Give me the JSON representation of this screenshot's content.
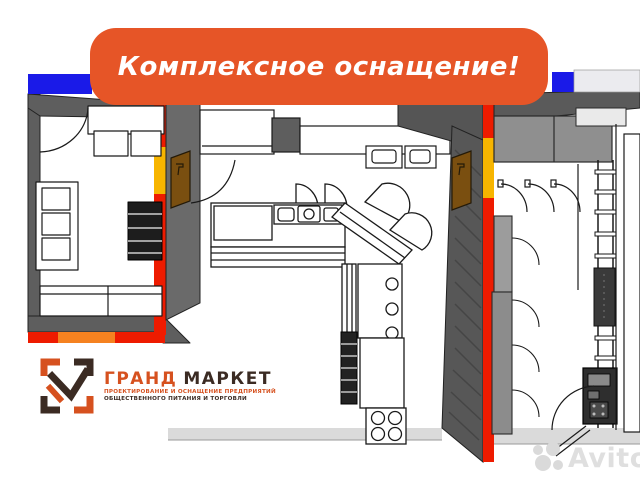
{
  "banner": {
    "text": "Комплексное оснащение!"
  },
  "logo": {
    "brand_first_word": "ГРАНД",
    "brand_second_word": "МАРКЕТ",
    "tagline_line1": "ПРОЕКТИРОВАНИЕ И ОСНАЩЕНИЕ ПРЕДПРИЯТИЙ",
    "tagline_line2": "ОБЩЕСТВЕННОГО ПИТАНИЯ И ТОРГОВЛИ"
  },
  "watermark": {
    "text": "Avito"
  },
  "palette": {
    "banner_orange": "#E65527",
    "wall_red": "#EE1B00",
    "wall_gray": "#5E5E5E",
    "cabinet_gray": "#8F8F8F",
    "accent_yellow": "#F7B500",
    "accent_blue": "#1A1AE8",
    "accent_orange": "#F58220",
    "door_brown": "#7A4F10",
    "logo_orange": "#D6511F",
    "logo_dark": "#3B2B23",
    "watermark_gray": "#DADADA"
  }
}
